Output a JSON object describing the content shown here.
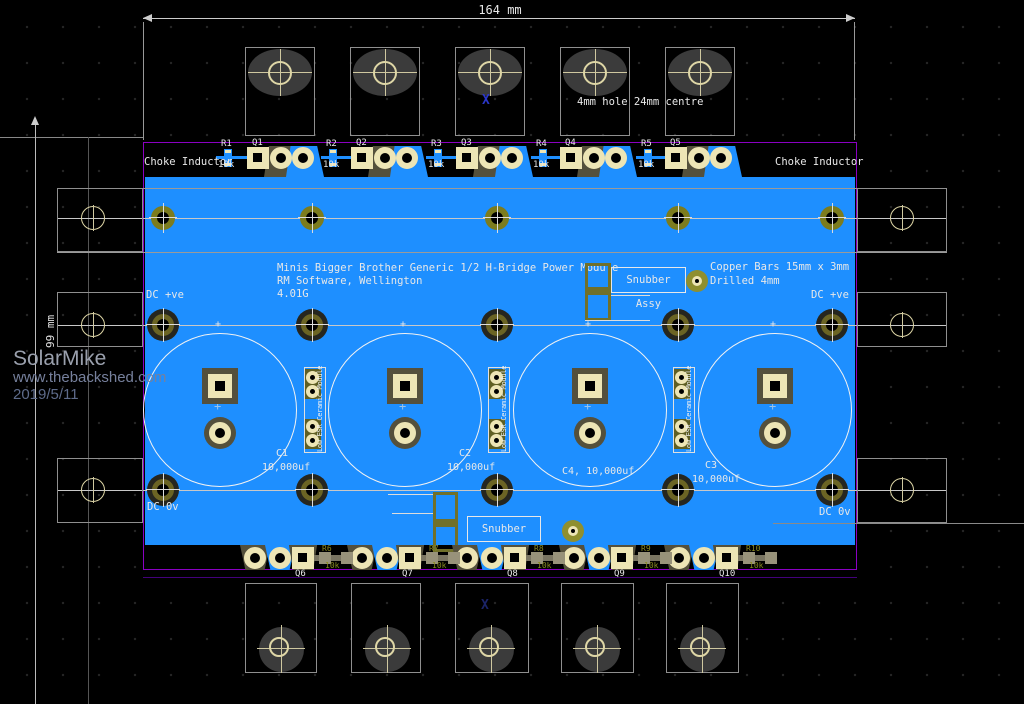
{
  "dimensions": {
    "horizontal": "164 mm",
    "vertical": "99 mm"
  },
  "watermark": {
    "name": "SolarMike",
    "url": "www.thebackshed.com",
    "date": "2019/5/11"
  },
  "annotations": {
    "hole_note": "4mm hole 24mm centre",
    "x_marker": "X",
    "copper_bars_line1": "Copper Bars 15mm x 3mm",
    "copper_bars_line2": "Drilled 4mm",
    "choke_inductor_left": "Choke Inductor",
    "choke_inductor_right": "Choke Inductor",
    "dc_positive_left": "DC +ve",
    "dc_positive_right": "DC +ve",
    "dc_zero_left": "DC 0v",
    "dc_zero_right": "DC 0v",
    "snubber_top": "Snubber Assy",
    "snubber_bottom": "Snubber Assy",
    "esr_module": "Low ESR Ceramic Module"
  },
  "title_block": {
    "line1": "Minis Bigger Brother Generic 1/2 H-Bridge Power Module",
    "line2": "RM Software, Wellington",
    "line3": "4.01G"
  },
  "top_row": {
    "resistors": [
      {
        "ref": "R1",
        "value": "10k"
      },
      {
        "ref": "R2",
        "value": "10k"
      },
      {
        "ref": "R3",
        "value": "10k"
      },
      {
        "ref": "R4",
        "value": "10k"
      },
      {
        "ref": "R5",
        "value": "10k"
      }
    ],
    "transistors": [
      {
        "ref": "Q1"
      },
      {
        "ref": "Q2"
      },
      {
        "ref": "Q3"
      },
      {
        "ref": "Q4"
      },
      {
        "ref": "Q5"
      }
    ]
  },
  "bottom_row": {
    "transistors": [
      {
        "ref": "Q6"
      },
      {
        "ref": "Q7"
      },
      {
        "ref": "Q8"
      },
      {
        "ref": "Q9"
      },
      {
        "ref": "Q10"
      }
    ],
    "resistors": [
      {
        "ref": "R6",
        "value": "10k"
      },
      {
        "ref": "R7",
        "value": "10k"
      },
      {
        "ref": "R8",
        "value": "10k"
      },
      {
        "ref": "R9",
        "value": "10k"
      },
      {
        "ref": "R10",
        "value": "10k"
      }
    ]
  },
  "capacitors": [
    {
      "ref": "C1",
      "value": "10,000uf"
    },
    {
      "ref": "C2",
      "value": "10,000uf"
    },
    {
      "ref": "C4,",
      "value": "10,000uf"
    },
    {
      "ref": "C3",
      "value": "10,000uf"
    }
  ],
  "colors": {
    "copper_pour": "#1E8FFF",
    "silkscreen": "#E8E8E8",
    "pad_cream": "#EDE5B5",
    "pad_olive": "#73731E",
    "board_outline": "#8A00C2"
  }
}
